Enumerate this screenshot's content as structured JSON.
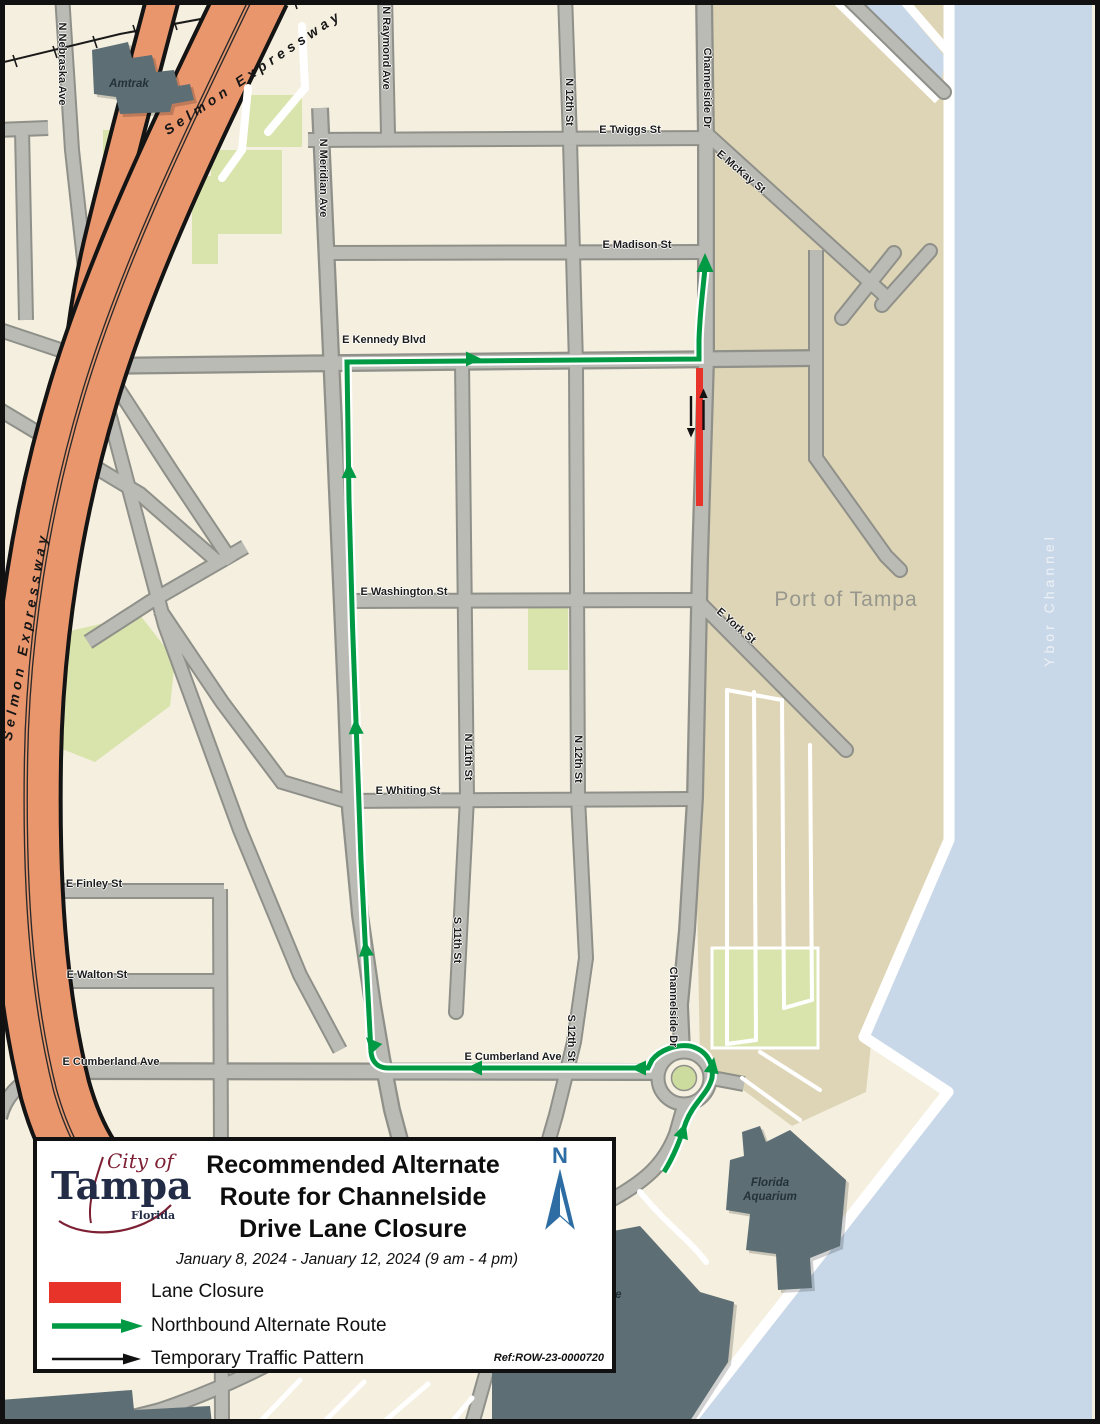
{
  "map": {
    "labels": [
      {
        "text": "N Nebraska Ave"
      },
      {
        "text": "N Raymond Ave"
      },
      {
        "text": "N Meridian Ave"
      },
      {
        "text": "N 12th St"
      },
      {
        "text": "Channelside Dr"
      },
      {
        "text": "E Twiggs St"
      },
      {
        "text": "E McKay St"
      },
      {
        "text": "E Madison St"
      },
      {
        "text": "E Kennedy Blvd"
      },
      {
        "text": "E Washington St"
      },
      {
        "text": "E Whiting St"
      },
      {
        "text": "E Finley St"
      },
      {
        "text": "E Walton St"
      },
      {
        "text": "E Cumberland Ave"
      },
      {
        "text": "E Cumberland Ave"
      },
      {
        "text": "N 11th St"
      },
      {
        "text": "N 12th St"
      },
      {
        "text": "S 11th St"
      },
      {
        "text": "S 12th St"
      },
      {
        "text": "Channelside Dr"
      },
      {
        "text": "E York St"
      },
      {
        "text": "Port of Tampa"
      },
      {
        "text": "Ybor Channel"
      },
      {
        "text": "Amtrak"
      },
      {
        "text": "Selmon Expressway"
      },
      {
        "text": "Selmon Expressway"
      },
      {
        "text": "Florida"
      },
      {
        "text": "Aquarium"
      },
      {
        "text": "side"
      }
    ]
  },
  "legend": {
    "logo": {
      "top": "City of",
      "main": "Tampa",
      "sub": "Florida"
    },
    "title_lines": [
      "Recommended Alternate",
      "Route for Channelside",
      "Drive Lane Closure"
    ],
    "date_range": "January 8, 2024 - January 12, 2024 (9 am - 4 pm)",
    "items": [
      {
        "label": "Lane Closure"
      },
      {
        "label": "Northbound Alternate Route"
      },
      {
        "label": "Temporary Traffic Pattern"
      }
    ],
    "ref": "Ref:ROW-23-0000720",
    "north_label": "N"
  },
  "colors": {
    "route_green": "#009a44",
    "closure_red": "#e8332a",
    "water_blue": "#c9d8e8",
    "port_tan": "#ded5b6",
    "road_gray": "#babbb5",
    "expressway_orange": "#e9966d",
    "north_arrow_blue": "#2e6da4",
    "park_green": "#d9e4ad",
    "building_gray": "#5d6e74"
  }
}
